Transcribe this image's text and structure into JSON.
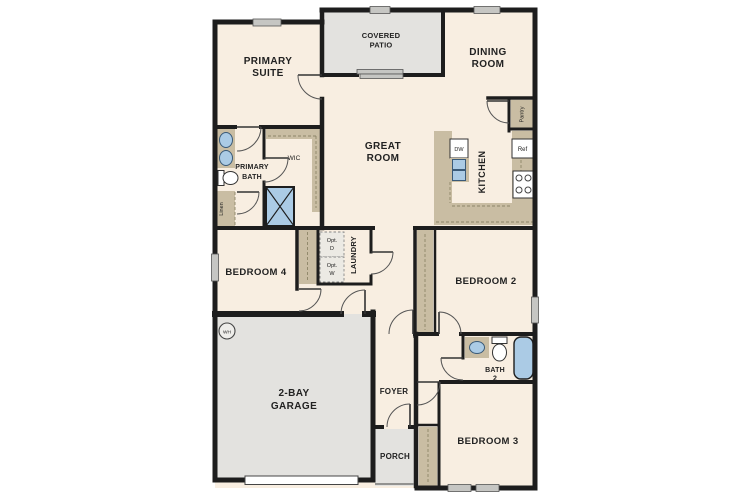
{
  "plan": {
    "rooms": {
      "primary_suite": {
        "line1": "PRIMARY",
        "line2": "SUITE"
      },
      "covered_patio": {
        "line1": "COVERED",
        "line2": "PATIO"
      },
      "dining_room": {
        "line1": "DINING",
        "line2": "ROOM"
      },
      "great_room": {
        "line1": "GREAT",
        "line2": "ROOM"
      },
      "kitchen": {
        "label": "KITCHEN"
      },
      "primary_bath": {
        "line1": "PRIMARY",
        "line2": "BATH"
      },
      "wic": {
        "label": "WIC"
      },
      "laundry": {
        "label": "LAUNDRY"
      },
      "bedroom_4": {
        "label": "BEDROOM 4"
      },
      "bedroom_2": {
        "label": "BEDROOM 2"
      },
      "bedroom_3": {
        "label": "BEDROOM 3"
      },
      "bath_2": {
        "line1": "BATH",
        "line2": "2"
      },
      "garage": {
        "line1": "2-BAY",
        "line2": "GARAGE"
      },
      "foyer": {
        "label": "FOYER"
      },
      "porch": {
        "label": "PORCH"
      },
      "pantry": {
        "label": "Pantry"
      },
      "linen": {
        "label": "Linen"
      }
    },
    "appliances": {
      "dishwasher": "DW",
      "refrigerator": "Ref",
      "water_heater": "WH",
      "opt_dryer_line1": "Opt.",
      "opt_dryer_line2": "D",
      "opt_washer_line1": "Opt.",
      "opt_washer_line2": "W"
    },
    "colors": {
      "interior": "#f8eee1",
      "outdoor": "#e3e2df",
      "wall": "#1d1d1d",
      "cabinet": "#c9bda3",
      "fixture_blue": "#abcbe5",
      "window": "#c6c6c3"
    }
  }
}
